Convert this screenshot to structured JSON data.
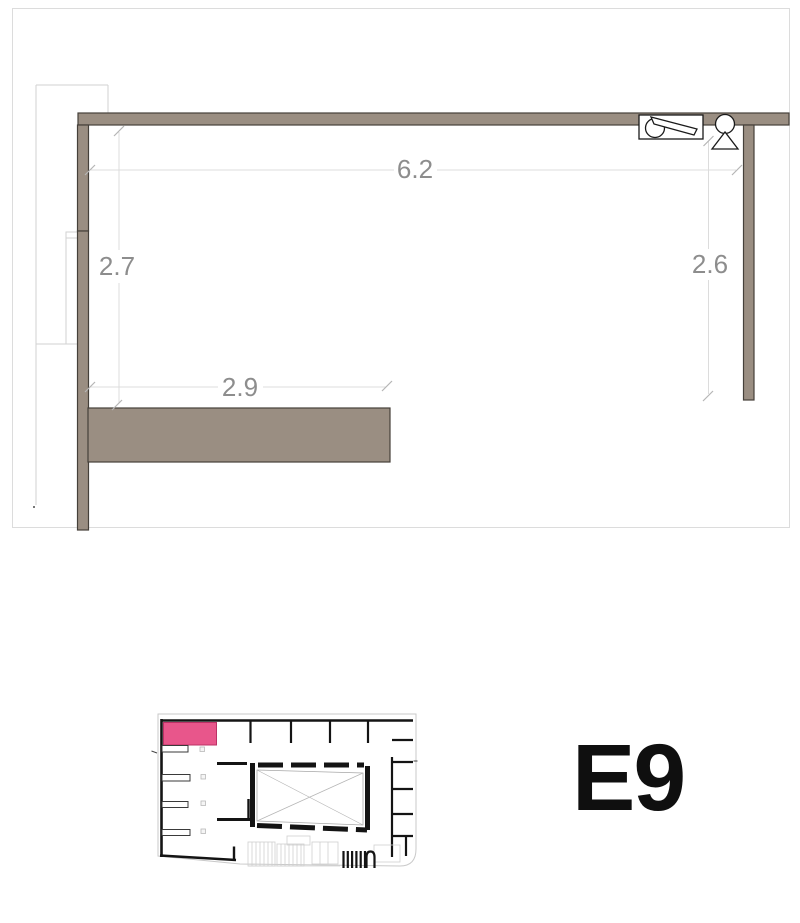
{
  "unit": {
    "label": "E9"
  },
  "dimensions": {
    "top": "6.2",
    "left": "2.7",
    "right": "2.6",
    "bottom": "2.9"
  },
  "colors": {
    "wall_fill": "#9a8e82",
    "wall_outline": "#45403a",
    "dimension_text": "#8d8d8d",
    "dimension_line": "#dcdcdc",
    "tick_mark": "#b5b5b5",
    "highlight_pink": "#e8568b",
    "plan_black": "#141414",
    "light_line": "#cccccc",
    "background": "#ffffff"
  },
  "minimap": {
    "highlighted_room": "E9"
  }
}
